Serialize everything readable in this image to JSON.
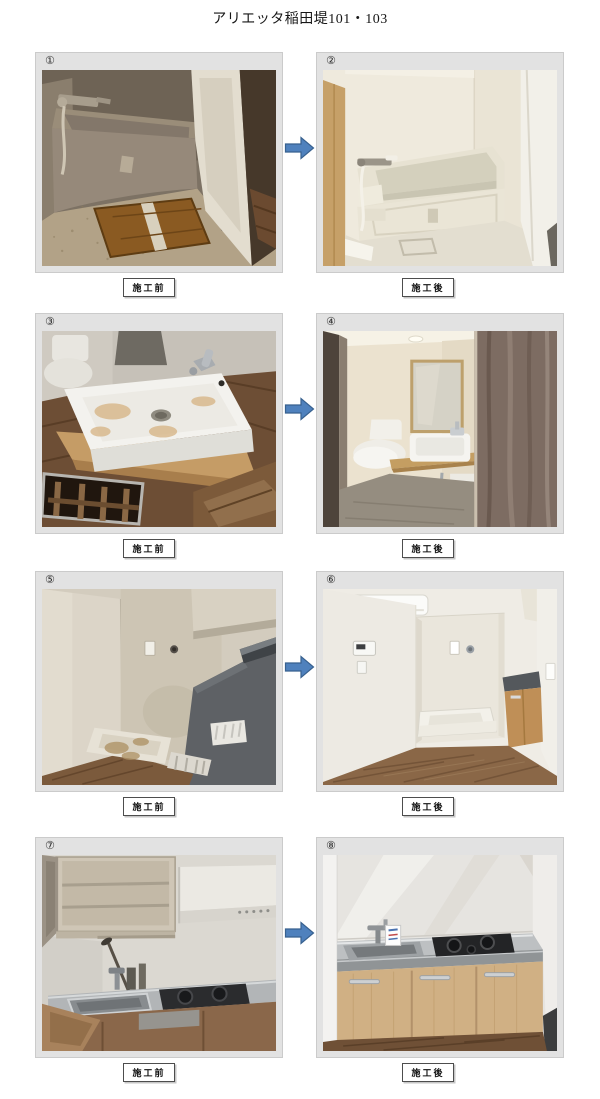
{
  "page": {
    "title": "アリエッタ稲田堤101・103"
  },
  "arrow": {
    "fill": "#4f81bd",
    "stroke": "#38618f"
  },
  "frame_color": "#e2e2e2",
  "rows": [
    {
      "before": {
        "number": "①",
        "caption": "施工前",
        "photo_desc": "unit-bath-bathtub-dirty"
      },
      "after": {
        "number": "②",
        "caption": "施工後",
        "photo_desc": "unit-bath-bathtub-renewed"
      }
    },
    {
      "before": {
        "number": "③",
        "caption": "施工前",
        "photo_desc": "washbasin-stained-open-floor-hatch"
      },
      "after": {
        "number": "④",
        "caption": "施工後",
        "photo_desc": "washroom-toilet-basin-renewed"
      }
    },
    {
      "before": {
        "number": "⑤",
        "caption": "施工前",
        "photo_desc": "laundry-corner-dirty-pan"
      },
      "after": {
        "number": "⑥",
        "caption": "施工後",
        "photo_desc": "laundry-corner-renewed-floor"
      }
    },
    {
      "before": {
        "number": "⑦",
        "caption": "施工前",
        "photo_desc": "kitchen-old-sink-stove"
      },
      "after": {
        "number": "⑧",
        "caption": "施工後",
        "photo_desc": "kitchen-new-counter-cabinets"
      }
    }
  ]
}
